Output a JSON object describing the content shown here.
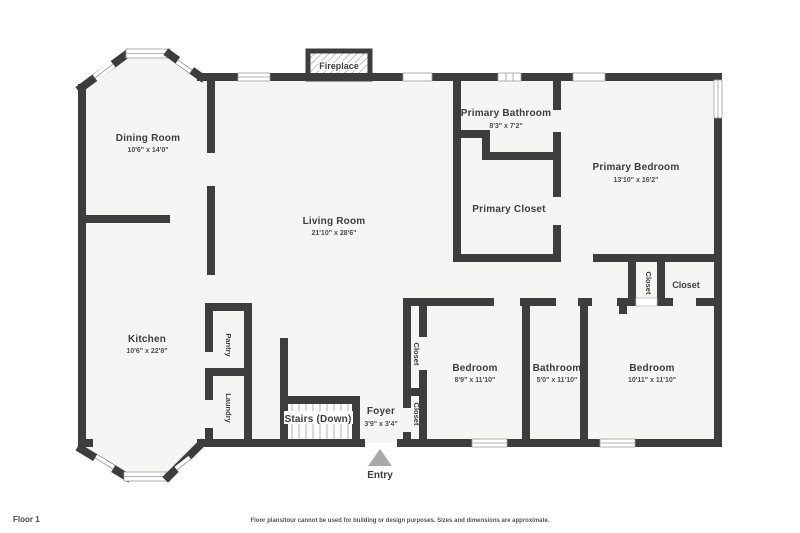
{
  "page": {
    "floor_label": "Floor 1",
    "disclaimer": "Floor plans/tour cannot be used for building or design purposes. Sizes and dimensions are approximate."
  },
  "colors": {
    "wall": "#3d3d3d",
    "floor": "#f5f5f3",
    "stairs_floor": "#fbfbfa",
    "entry_arrow": "#a9a9a9"
  },
  "features": {
    "fireplace": "Fireplace",
    "entry": "Entry"
  },
  "rooms": {
    "dining_room": {
      "name": "Dining Room",
      "dims": "10'6\" x 14'0\""
    },
    "living_room": {
      "name": "Living Room",
      "dims": "21'10\" x 28'6\""
    },
    "kitchen": {
      "name": "Kitchen",
      "dims": "10'6\" x 22'8\""
    },
    "pantry": {
      "name": "Pantry"
    },
    "laundry": {
      "name": "Laundry"
    },
    "stairs": {
      "name": "Stairs (Down)"
    },
    "foyer": {
      "name": "Foyer",
      "dims": "3'9\" x 3'4\""
    },
    "primary_bathroom": {
      "name": "Primary Bathroom",
      "dims": "8'3\" x 7'2\""
    },
    "primary_closet": {
      "name": "Primary Closet"
    },
    "primary_bedroom": {
      "name": "Primary Bedroom",
      "dims": "13'10\" x 16'2\""
    },
    "bedroom_1": {
      "name": "Bedroom",
      "dims": "8'9\" x 11'10\""
    },
    "hall_bathroom": {
      "name": "Bathroom",
      "dims": "5'0\" x 11'10\""
    },
    "bedroom_2": {
      "name": "Bedroom",
      "dims": "10'11\" x 11'10\""
    },
    "closet_hall_small": {
      "name": "Closet"
    },
    "closet_hall_large": {
      "name": "Closet"
    },
    "closet_bedroom1": {
      "name": "Closet"
    },
    "closet_foyer": {
      "name": "Closet"
    }
  }
}
